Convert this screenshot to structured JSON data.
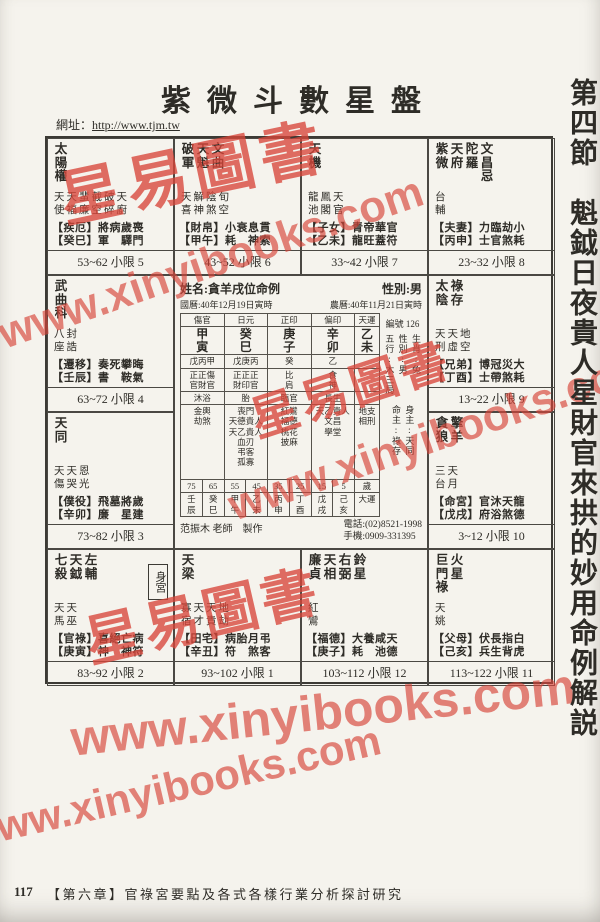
{
  "page": {
    "title": "紫微斗數星盤",
    "url_label": "網址：",
    "url": "http://www.tjm.tw",
    "section_heading": "第四節　魁鉞日夜貴人星財官來拱的妙用命例解説",
    "page_number": "117",
    "footer": "【第六章】官祿宮要點及各式各樣行業分析探討研究"
  },
  "watermarks": {
    "stamp": "星易圖書",
    "url": "www.xinyibooks.com",
    "color": "#d8463a"
  },
  "chart": {
    "palaces": [
      {
        "stars": [
          "太陽權"
        ],
        "minor1": "天天蜚截破天",
        "minor2": "使福廉空碎廚",
        "line1": "【疾厄】將病歲喪",
        "line2": "【癸巳】軍　驛門",
        "limit": "53~62 小限 5"
      },
      {
        "stars": [
          "破軍",
          "天魁",
          "文曲"
        ],
        "minor1": "天解陰旬",
        "minor2": "喜神煞空",
        "line1": "【財帛】小衰息貫",
        "line2": "【甲午】耗　神索",
        "limit": "43~52 小限 6"
      },
      {
        "stars": [
          "天機"
        ],
        "minor1": "龍鳳天",
        "minor2": "池閣官",
        "line1": "【子女】青帝華官",
        "line2": "【乙未】龍旺蓋符",
        "limit": "33~42 小限 7"
      },
      {
        "stars": [
          "紫微",
          "天府",
          "陀羅",
          "文昌忌"
        ],
        "minor1": "台",
        "minor2": "輔",
        "line1": "【夫妻】力臨劫小",
        "line2": "【丙申】士官煞耗",
        "limit": "23~32 小限 8"
      },
      {
        "stars": [
          "太陰",
          "祿存"
        ],
        "minor1": "天天地",
        "minor2": "刑虛空",
        "line1": "【兄弟】博冠災大",
        "line2": "【丁酉】士帶煞耗",
        "limit": "13~22 小限 9"
      },
      {
        "stars": [
          "貪狼",
          "擎羊"
        ],
        "minor1": "三天",
        "minor2": "台月",
        "line1": "【命宮】官沐天龍",
        "line2": "【戊戌】府浴煞德",
        "limit": "3~12 小限 10"
      },
      {
        "stars": [
          "巨門祿",
          "火星"
        ],
        "minor1": "天",
        "minor2": "姚",
        "line1": "【父母】伏長指白",
        "line2": "【己亥】兵生背虎",
        "limit": "113~122 小限 11"
      },
      {
        "stars": [
          "廉貞",
          "天相",
          "右弼",
          "鈴星"
        ],
        "minor1": "紅",
        "minor2": "鸞",
        "line1": "【福德】大養咸天",
        "line2": "【庚子】耗　池德",
        "limit": "103~112 小限 12"
      },
      {
        "stars": [
          "天梁"
        ],
        "minor1": "寡天天地",
        "minor2": "宿才貴劫",
        "line1": "【田宅】病胎月弔",
        "line2": "【辛丑】符　煞客",
        "limit": "93~102 小限 1"
      },
      {
        "stars": [
          "七殺",
          "天鉞",
          "左輔"
        ],
        "minor1": "天天",
        "minor2": "馬巫",
        "line1": "【官祿】喜絕亡病",
        "line2": "【庚寅】神　神符",
        "limit": "83~92 小限 2",
        "badge": "身宮"
      },
      {
        "stars": [
          "天同"
        ],
        "minor1": "天天恩",
        "minor2": "傷哭光",
        "line1": "【僕役】飛墓將歲",
        "line2": "【辛卯】廉　星建",
        "limit": "73~82 小限 3"
      },
      {
        "stars": [
          "武曲科"
        ],
        "minor1": "八封",
        "minor2": "座誥",
        "line1": "【遷移】奏死攀晦",
        "line2": "【壬辰】書　鞍氣",
        "limit": "63~72 小限 4"
      }
    ],
    "center": {
      "name": "姓名:貪羊戌位命例",
      "gender": "性別:男",
      "solar": "國曆:40年12月19日寅時",
      "lunar": "農曆:40年11月21日寅時",
      "serial": "編號 126",
      "pillars": {
        "headers": [
          "傷官",
          "日元",
          "正印",
          "偏印",
          "天運"
        ],
        "pillars": [
          "甲\n寅",
          "癸\n巳",
          "庚\n子",
          "辛\n卯",
          "乙\n未"
        ],
        "hidden": [
          "戊丙甲",
          "戊庚丙",
          "癸",
          "乙",
          ""
        ],
        "gods": [
          "正正傷\n官財官",
          "正正正\n財印官",
          "比\n肩",
          "食\n神",
          ""
        ],
        "stages": [
          "沐浴",
          "胎",
          "臨官",
          "長生",
          ""
        ],
        "stars": [
          "金輿\n劫煞",
          "喪門\n天德貴人\n天乙貴人\n血刃\n弔客\n孤寡",
          "紅鸞\n福德\n桃花\n披麻",
          "天乙貴人\n文昌\n學堂",
          "地支相刑"
        ]
      },
      "luck_ages": [
        "75",
        "65",
        "55",
        "45",
        "35",
        "25",
        "15",
        "5",
        "歲"
      ],
      "luck_pillars": [
        "壬\n辰",
        "癸\n巳",
        "甲\n午",
        "乙\n未",
        "丙\n申",
        "丁\n酉",
        "戊\n戌",
        "己\n亥",
        "大運"
      ],
      "attrs_main": [
        "五行:木三局",
        "性別:男",
        "生肖:兔"
      ],
      "attrs_lords": [
        "命主:祿存",
        "身主:天同"
      ],
      "maker": "范振木 老師　製作",
      "phone": "電話:(02)8521-1998",
      "mobile": "手機:0909-331395"
    }
  }
}
